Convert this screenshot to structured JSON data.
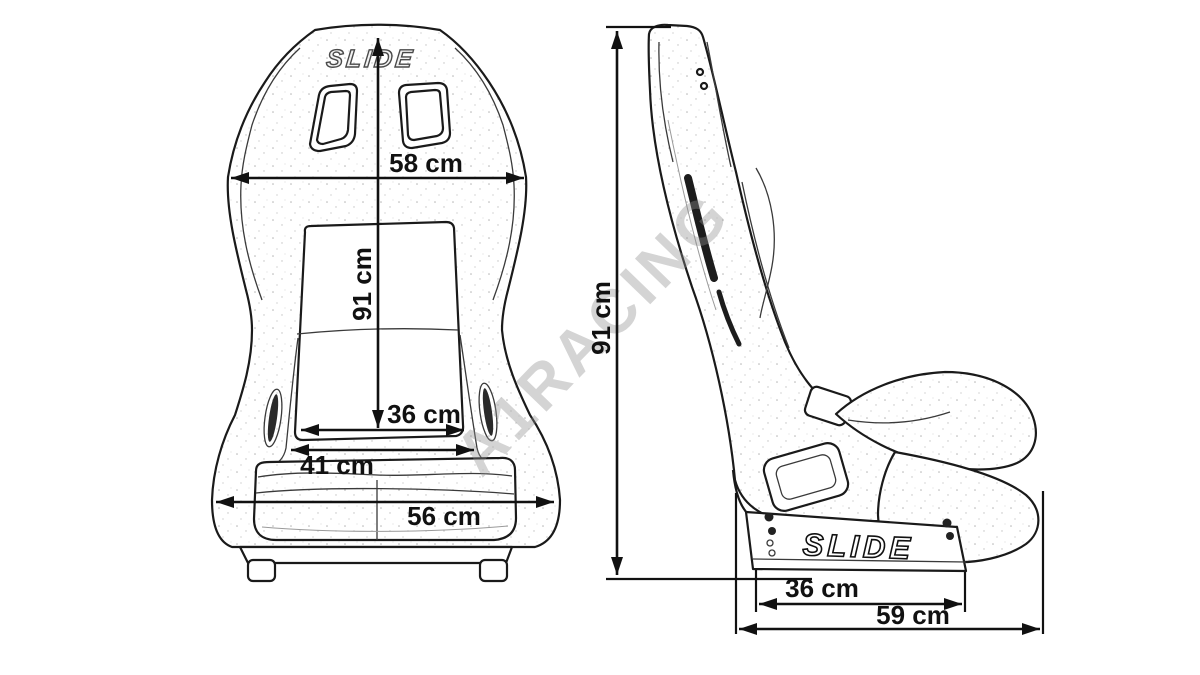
{
  "colors": {
    "background": "#ffffff",
    "line": "#1a1a1a",
    "dimension_text": "#111111",
    "watermark_gray": "#c9c9c9"
  },
  "watermark": {
    "text": "A1RACING"
  },
  "front_view": {
    "logo": "SLIDE",
    "dims": {
      "shoulder_width": "58 cm",
      "height": "91 cm",
      "backrest_inner_width": "36 cm",
      "hip_width": "41 cm",
      "cushion_width": "56 cm"
    }
  },
  "side_view": {
    "logo": "SLIDE",
    "dims": {
      "height": "91 cm",
      "mount_rail_length": "36 cm",
      "overall_depth": "59 cm"
    }
  }
}
